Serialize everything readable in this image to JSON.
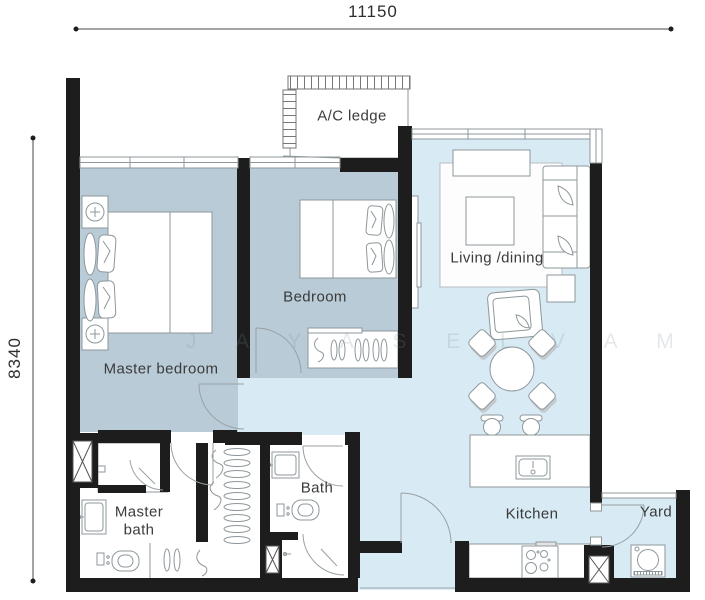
{
  "dimensions": {
    "top": "11150",
    "left": "8340"
  },
  "labels": {
    "ac_ledge": "A/C ledge",
    "master_bedroom": "Master bedroom",
    "bedroom": "Bedroom",
    "living_dining": "Living /dining",
    "master_bath_line1": "Master",
    "master_bath_line2": "bath",
    "bath": "Bath",
    "kitchen": "Kitchen",
    "yard": "Yard"
  },
  "watermark": {
    "text": "J A Y A S E L V A M"
  },
  "colors": {
    "wall": "#1d1d1d",
    "bedroom_floor": "#b9cbd6",
    "living_floor": "#d8eaf4",
    "outline": "#8e979b",
    "text": "#3b3b3b",
    "dimension_line": "#4a4a4a"
  },
  "icons": {
    "shaft": "box-with-x-cross",
    "bedside_lamp": "circle-with-cross",
    "door": "quarter-arc-swing",
    "window": "double-line-glazing",
    "ac_louvre": "hatched-strip"
  }
}
